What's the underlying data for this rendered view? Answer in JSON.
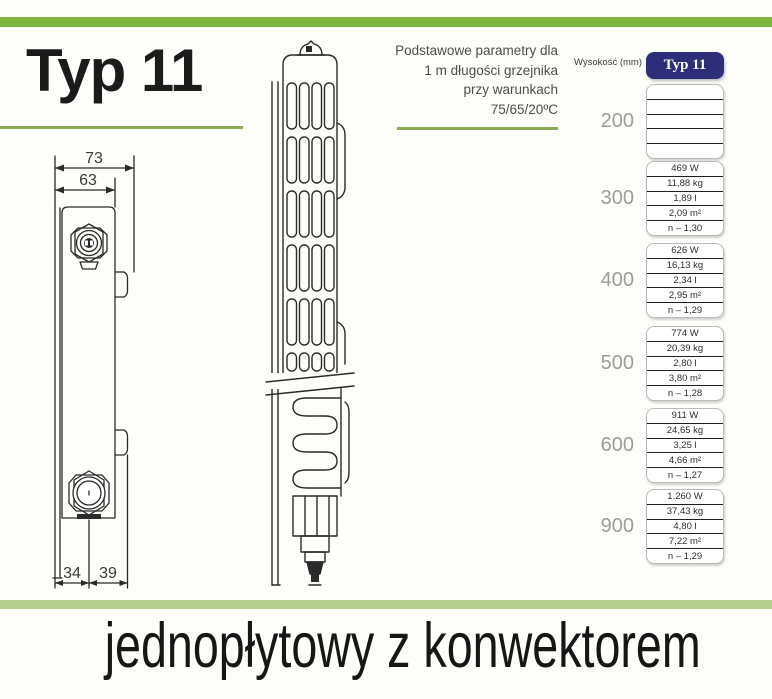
{
  "title": "Typ 11",
  "note": {
    "line1": "Podstawowe parametry dla",
    "line2": "1 m długości grzejnika",
    "line3": "przy warunkach",
    "line4": "75/65/20ºC"
  },
  "drawing": {
    "dim_outer_width": "73",
    "dim_inner_width": "63",
    "dim_bottom_left": "34",
    "dim_bottom_right": "39"
  },
  "table": {
    "height_header": "Wysokość (mm)",
    "column_header": "Typ 11",
    "groups": [
      {
        "height": "200",
        "values": [
          "",
          "",
          "",
          "",
          ""
        ]
      },
      {
        "height": "300",
        "values": [
          "469 W",
          "11,88 kg",
          "1,89 l",
          "2,09 m²",
          "n – 1,30"
        ]
      },
      {
        "height": "400",
        "values": [
          "626 W",
          "16,13 kg",
          "2,34 l",
          "2,95 m²",
          "n – 1,29"
        ]
      },
      {
        "height": "500",
        "values": [
          "774 W",
          "20,39 kg",
          "2,80 l",
          "3,80 m²",
          "n – 1,28"
        ]
      },
      {
        "height": "600",
        "values": [
          "911 W",
          "24,65 kg",
          "3,25 l",
          "4,66 m²",
          "n – 1,27"
        ]
      },
      {
        "height": "900",
        "values": [
          "1.260 W",
          "37,43 kg",
          "4,80 l",
          "7,22 m²",
          "n – 1,29"
        ]
      }
    ]
  },
  "footer": {
    "caption": "jednopłytowy z konwektorem"
  },
  "colors": {
    "accent_green": "#7cb53f",
    "underline_green": "#8ba957",
    "footer_band_green": "#b6cd90",
    "header_navy": "#2d2d7a"
  }
}
